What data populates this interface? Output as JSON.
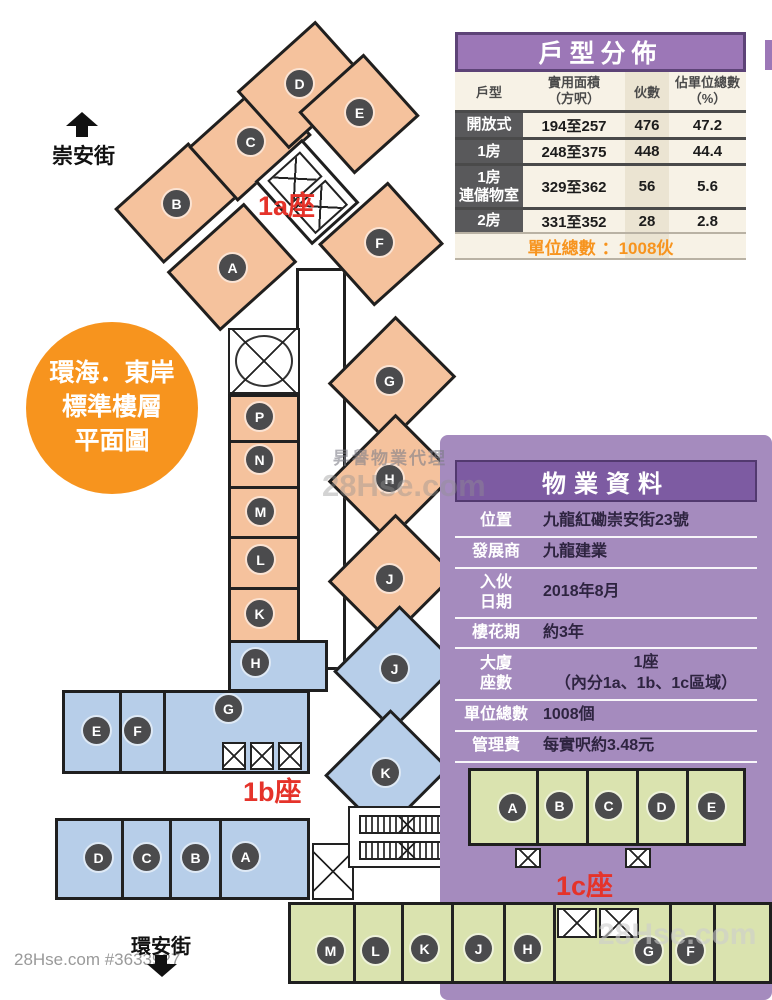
{
  "source": {
    "footer_id": "28Hse.com #3633927"
  },
  "watermarks": {
    "agency": "昇譽物業代理",
    "brand_center": "28Hse.com",
    "brand_bottom": "28Hse.com"
  },
  "badge": {
    "line1": "環海．東岸",
    "line2": "標準樓層",
    "line3": "平面圖"
  },
  "streets": {
    "top": "崇安街",
    "bottom": "環安街"
  },
  "unit_table": {
    "title": "戶型分佈",
    "columns": [
      {
        "l1": "戶型",
        "l2": ""
      },
      {
        "l1": "實用面積",
        "l2": "（方呎）"
      },
      {
        "l1": "伙數",
        "l2": ""
      },
      {
        "l1": "佔單位總數",
        "l2": "（%）"
      }
    ],
    "rows": [
      {
        "type": "開放式",
        "type2": "",
        "area": "194至257",
        "units": "476",
        "pct": "47.2"
      },
      {
        "type": "1房",
        "type2": "",
        "area": "248至375",
        "units": "448",
        "pct": "44.4"
      },
      {
        "type": "1房",
        "type2": "連儲物室",
        "area": "329至362",
        "units": "56",
        "pct": "5.6"
      },
      {
        "type": "2房",
        "type2": "",
        "area": "331至352",
        "units": "28",
        "pct": "2.8"
      }
    ],
    "total_label": "單位總數",
    "total_value": "：1008伙"
  },
  "property_table": {
    "title": "物業資料",
    "rows": [
      {
        "label": "位置",
        "label2": "",
        "value": "九龍紅磡崇安街23號",
        "value2": ""
      },
      {
        "label": "發展商",
        "label2": "",
        "value": "九龍建業",
        "value2": ""
      },
      {
        "label": "入伙",
        "label2": "日期",
        "value": "2018年8月",
        "value2": ""
      },
      {
        "label": "樓花期",
        "label2": "",
        "value": "約3年",
        "value2": ""
      },
      {
        "label": "大廈",
        "label2": "座數",
        "value": "1座",
        "value2": "（內分1a、1b、1c區域）"
      },
      {
        "label": "單位總數",
        "label2": "",
        "value": "1008個",
        "value2": ""
      },
      {
        "label": "管理費",
        "label2": "",
        "value": "每實呎約3.48元",
        "value2": ""
      }
    ]
  },
  "plan": {
    "wing_labels": {
      "a": "1a座",
      "b": "1b座",
      "c": "1c座"
    },
    "circle_letters": [
      "A",
      "B",
      "C",
      "D",
      "E",
      "F",
      "P",
      "N",
      "M",
      "L",
      "K",
      "G",
      "H",
      "J",
      "H",
      "E",
      "F",
      "G",
      "J",
      "K",
      "D",
      "C",
      "B",
      "A",
      "A",
      "B",
      "C",
      "D",
      "E",
      "M",
      "L",
      "K",
      "J",
      "H",
      "G",
      "F"
    ]
  },
  "colors": {
    "orange_unit": "#F5C29D",
    "blue_unit": "#B7CEE9",
    "green_unit": "#DAE3AF",
    "purple_panel": "#A58BBE",
    "purple_header": "#7D5BA2",
    "table_header_purple": "#9C77B7",
    "accent_orange": "#F7941E",
    "red_label": "#E5332A",
    "circle_gray": "#4B4B4D"
  }
}
